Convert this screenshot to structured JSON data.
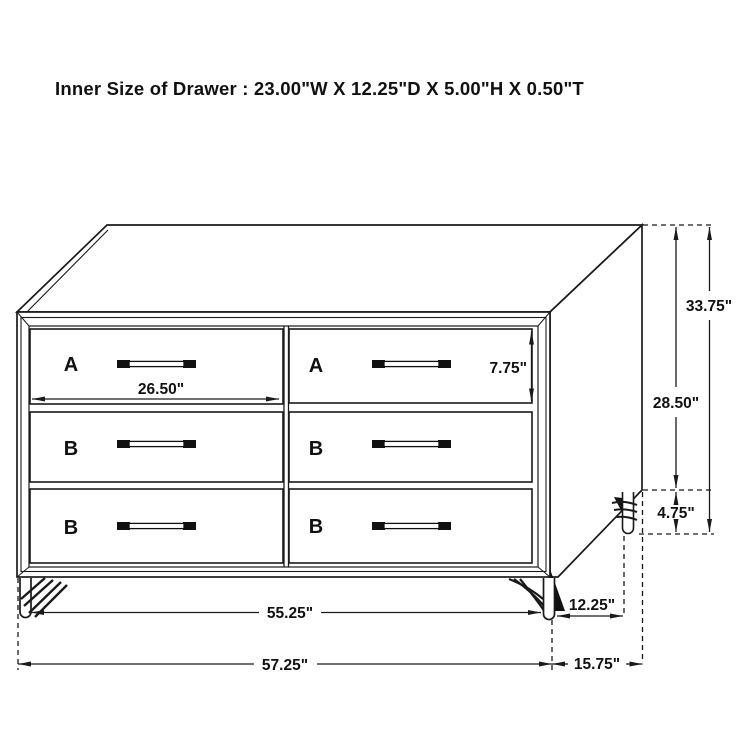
{
  "title": "Inner Size of Drawer : 23.00\"W X 12.25\"D X 5.00\"H X 0.50\"T",
  "colors": {
    "line": "#1a1a1a",
    "label_red": "#b01f24",
    "background": "#ffffff"
  },
  "drawers": [
    {
      "id": "top-left",
      "label": "A"
    },
    {
      "id": "top-right",
      "label": "A"
    },
    {
      "id": "middle-left",
      "label": "B"
    },
    {
      "id": "middle-right",
      "label": "B"
    },
    {
      "id": "bottom-left",
      "label": "B"
    },
    {
      "id": "bottom-right",
      "label": "B"
    }
  ],
  "dimensions": {
    "drawer_width": "26.50\"",
    "drawer_front_height": "7.75\"",
    "total_height": "33.75\"",
    "case_height": "28.50\"",
    "leg_height": "4.75\"",
    "leg_span_width": "55.25\"",
    "leg_span_depth": "12.25\"",
    "total_width": "57.25\"",
    "total_depth": "15.75\""
  }
}
